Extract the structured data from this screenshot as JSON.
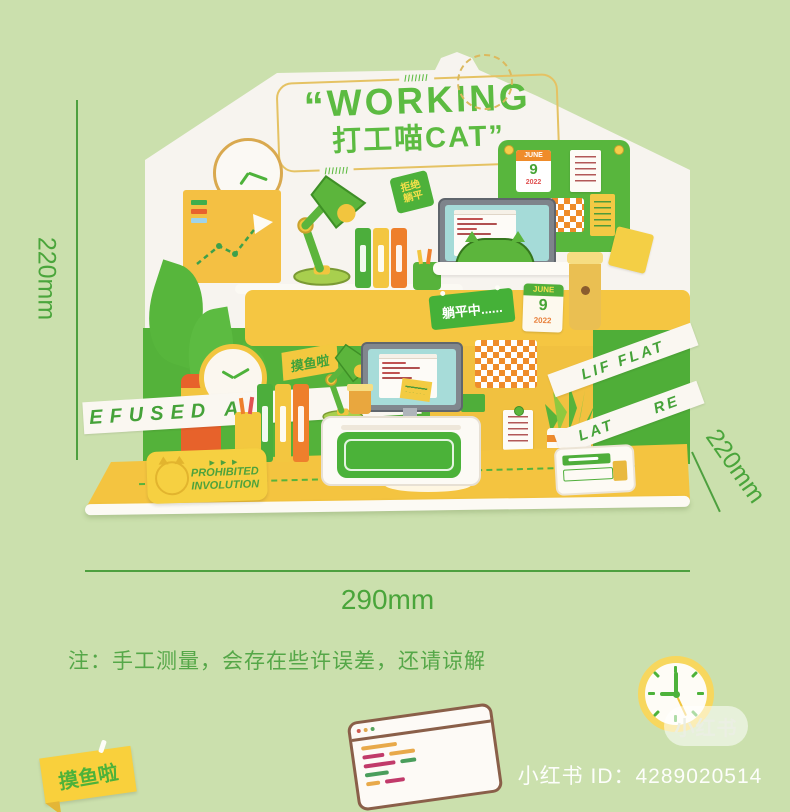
{
  "page": {
    "note": "注：手工测量，会存在些许误差，还请谅解",
    "dimensions": {
      "left": "220mm",
      "right": "220mm",
      "bottom": "290mm"
    }
  },
  "product": {
    "title_quote_open": "“",
    "title_line1": "WORKING",
    "title_line2": "打工喵CAT”",
    "hatch": "///////",
    "flag": {
      "line1": "拒绝",
      "line2": "躺平"
    },
    "tape_refused": "EFUSED A",
    "tag_moyu": "摸鱼啦",
    "sign_tangping": "躺平中......",
    "prohibited": {
      "line1": "PROHIBITED",
      "line2": "INVOLUTION",
      "arrows": "▶ ▶ ▶"
    },
    "tape_lie_top": "LIF FLAT",
    "tape_lie_bottom": "LAT      RE",
    "calendar_board": {
      "month": "JUNE",
      "day": "9",
      "year": "2022"
    },
    "calendar_desk": {
      "month": "JUNE",
      "day": "9",
      "year": "2022"
    }
  },
  "footer": {
    "sticker": "摸鱼啦",
    "watermark": "小红书",
    "id_line": "小红书 ID：4289020514"
  }
}
